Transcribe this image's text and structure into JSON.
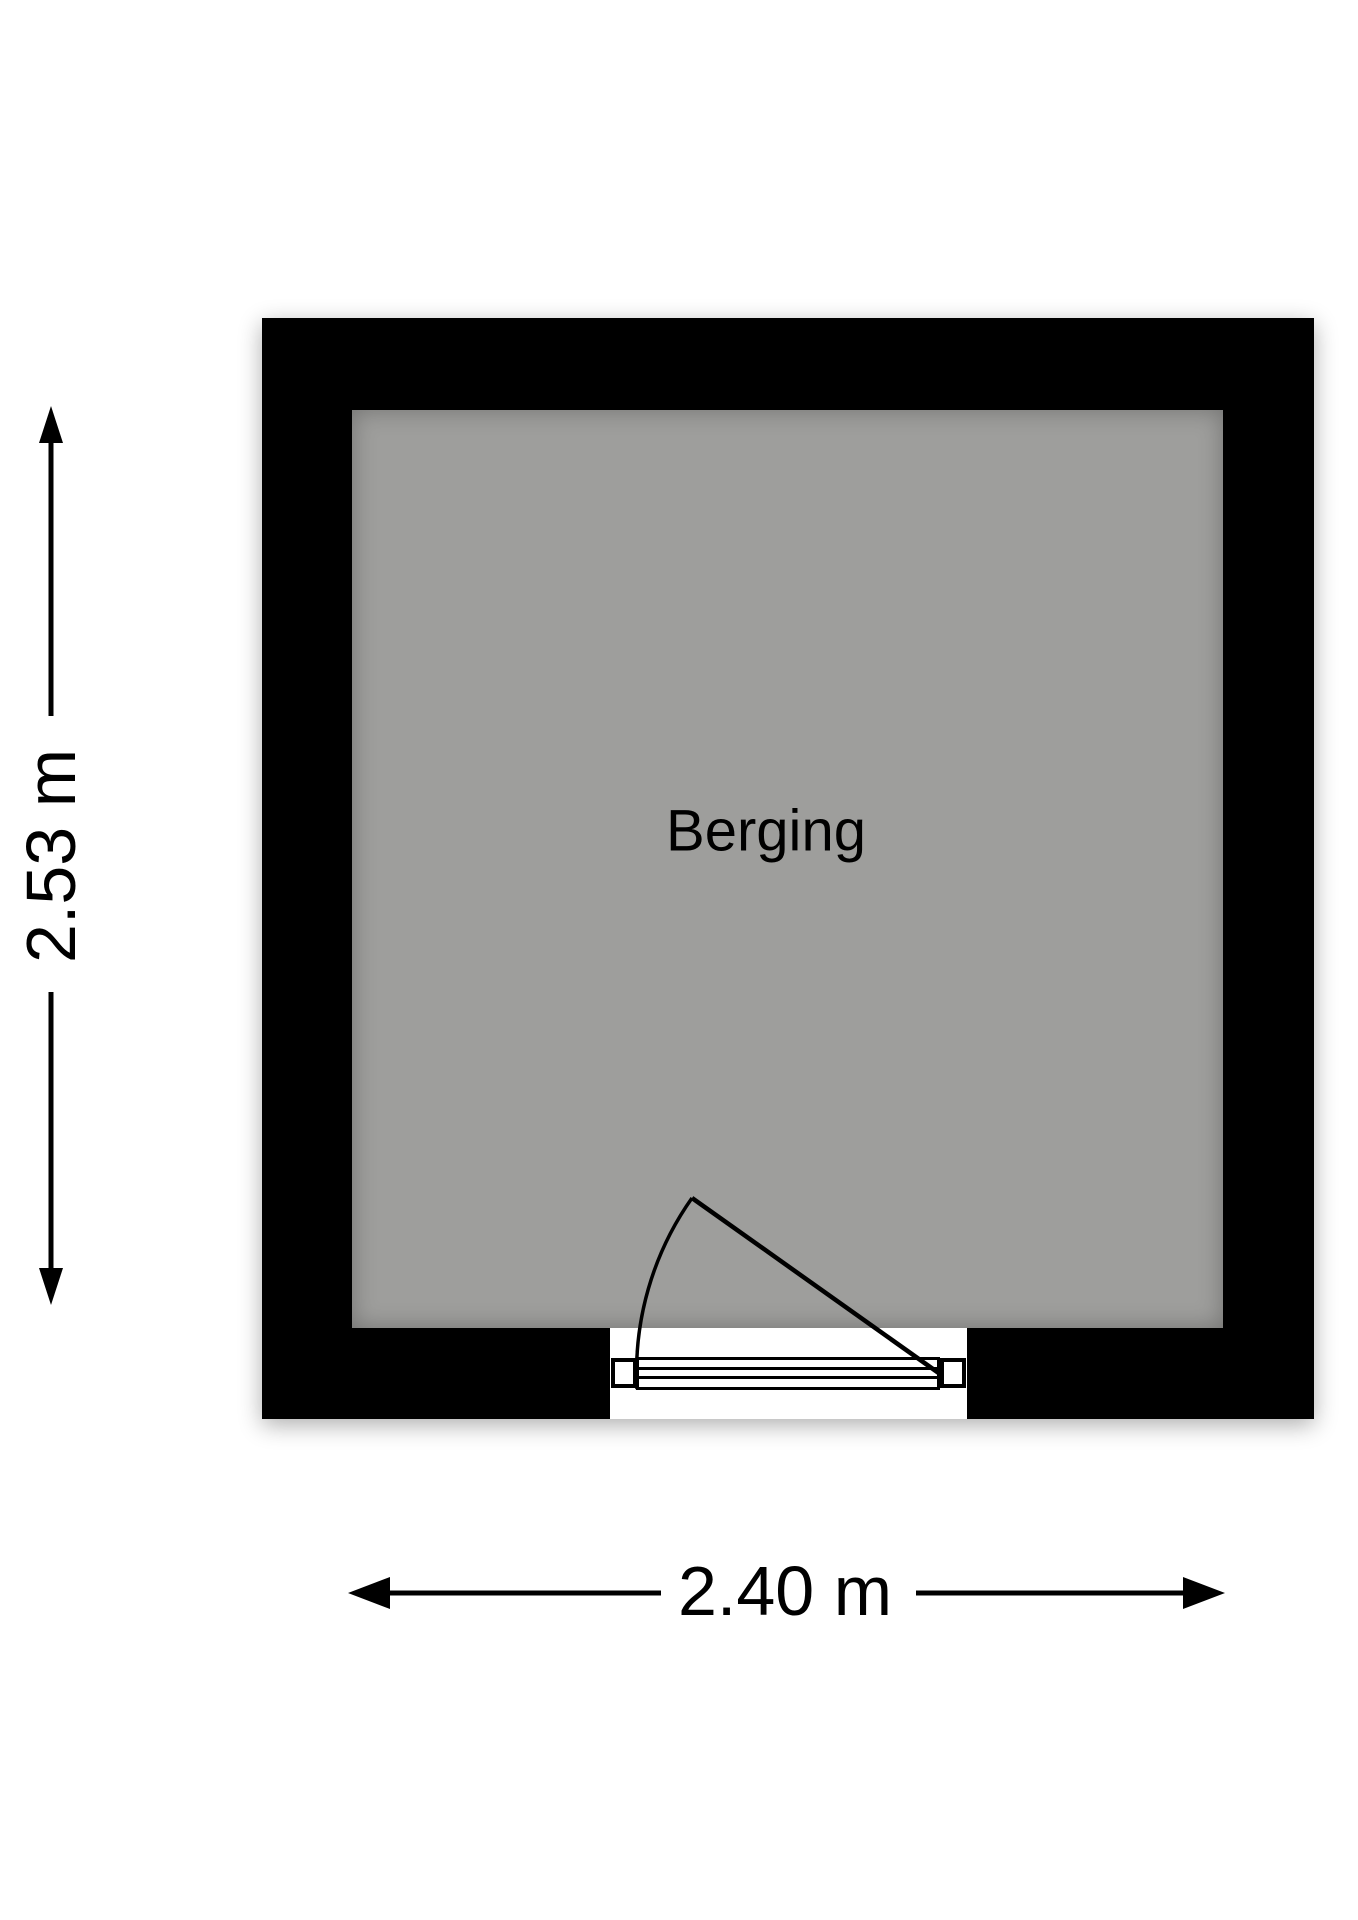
{
  "floorplan": {
    "room_label": "Berging",
    "vertical_dimension": "2.53 m",
    "horizontal_dimension": "2.40 m",
    "colors": {
      "wall": "#000000",
      "floor": "#9e9e9c",
      "background": "#ffffff",
      "lines_and_text": "#000000"
    },
    "icons": {
      "door": "door-swing-arc",
      "vertical_measure": "double-headed-arrow-vertical",
      "horizontal_measure": "double-headed-arrow-horizontal"
    }
  }
}
